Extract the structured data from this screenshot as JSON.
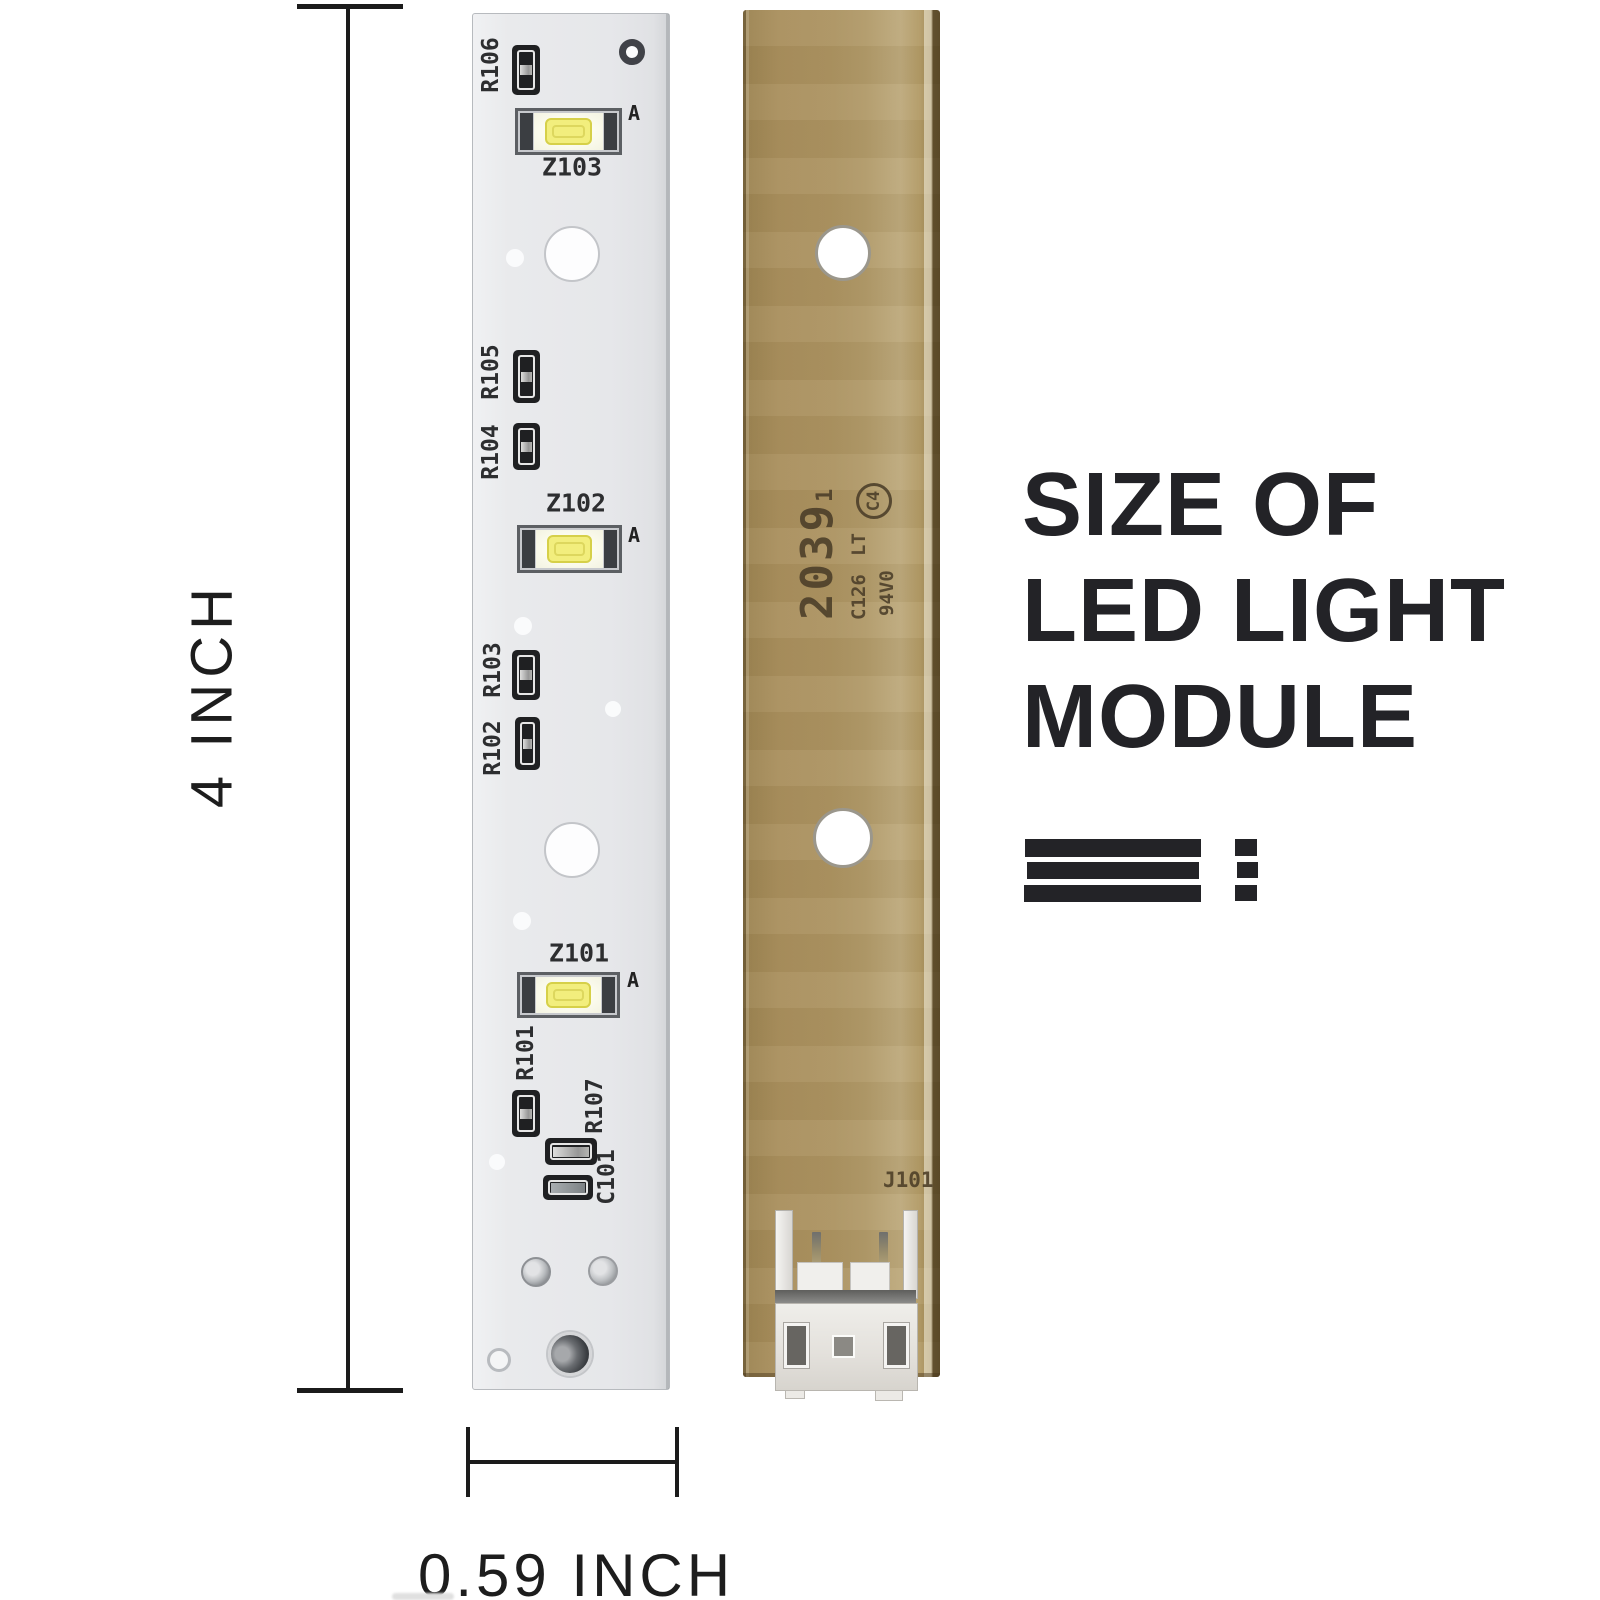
{
  "title": {
    "line1": "SIZE OF",
    "line2": "LED LIGHT",
    "line3": "MODULE"
  },
  "dimensions": {
    "height_label": "4 INCH",
    "width_label": "0.59 INCH"
  },
  "front_board": {
    "refs": [
      "R106",
      "R105",
      "R104",
      "R103",
      "R102",
      "R101",
      "R107",
      "C101"
    ],
    "leds": [
      "Z103",
      "Z102",
      "Z101"
    ],
    "anode_mark": "A"
  },
  "back_board": {
    "markings": {
      "date_code": "2039",
      "date_code_sub": "1",
      "line1": "LT",
      "line2": "C126",
      "flammability": "94V0",
      "cert": "C4"
    },
    "connector_label": "J101"
  },
  "colors": {
    "front_board": "#e8e9eb",
    "back_board": "#ac9361",
    "led_emitter": "#f2ee7d",
    "dimension_ink": "#1b1b1b",
    "title_ink": "#232327"
  }
}
